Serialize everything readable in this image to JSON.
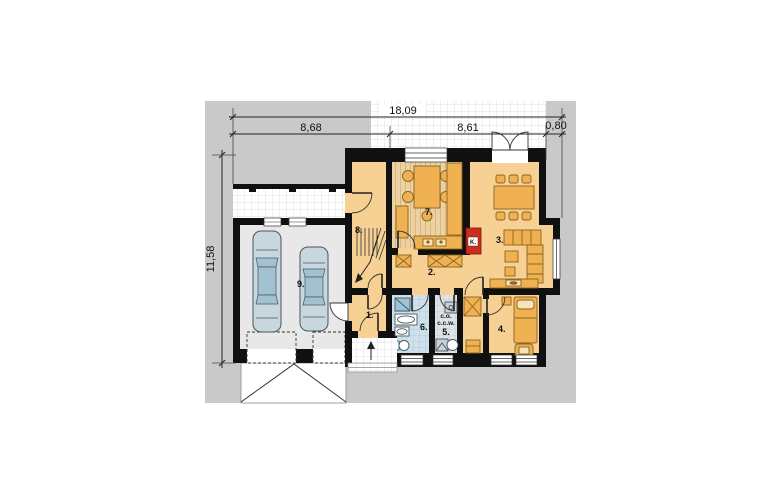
{
  "plan": {
    "dimensions": {
      "total_width": "18,09",
      "left_section": "8,68",
      "house_section": "8,61",
      "bay_section": "0,80",
      "side_height": "11,58"
    },
    "rooms": {
      "r1": "1.",
      "r2": "2.",
      "r3": "3.",
      "r4": "4.",
      "r5": "5.",
      "r6": "6.",
      "r7": "7.",
      "r8": "8.",
      "r9": "9."
    },
    "labels": {
      "fireplace": "K.",
      "heating": "c.o.",
      "hot_water": "c.c.w."
    },
    "colors": {
      "plot_gray": "#c9c9c9",
      "wall_black": "#101010",
      "floor_orange": "#f6d193",
      "kitchen_floor": "#ecd2a2",
      "furniture_orange": "#f0b152",
      "furniture_stroke": "#8a6420",
      "bath_blue": "#cfe2ec",
      "tech_gray": "#dfe4e8",
      "garage_floor": "#e8e8e8",
      "fireplace_red": "#c92f21",
      "car_body": "#c8d6dd",
      "car_glass": "#a3c2d1",
      "pillow": "#f8e3b8"
    }
  }
}
